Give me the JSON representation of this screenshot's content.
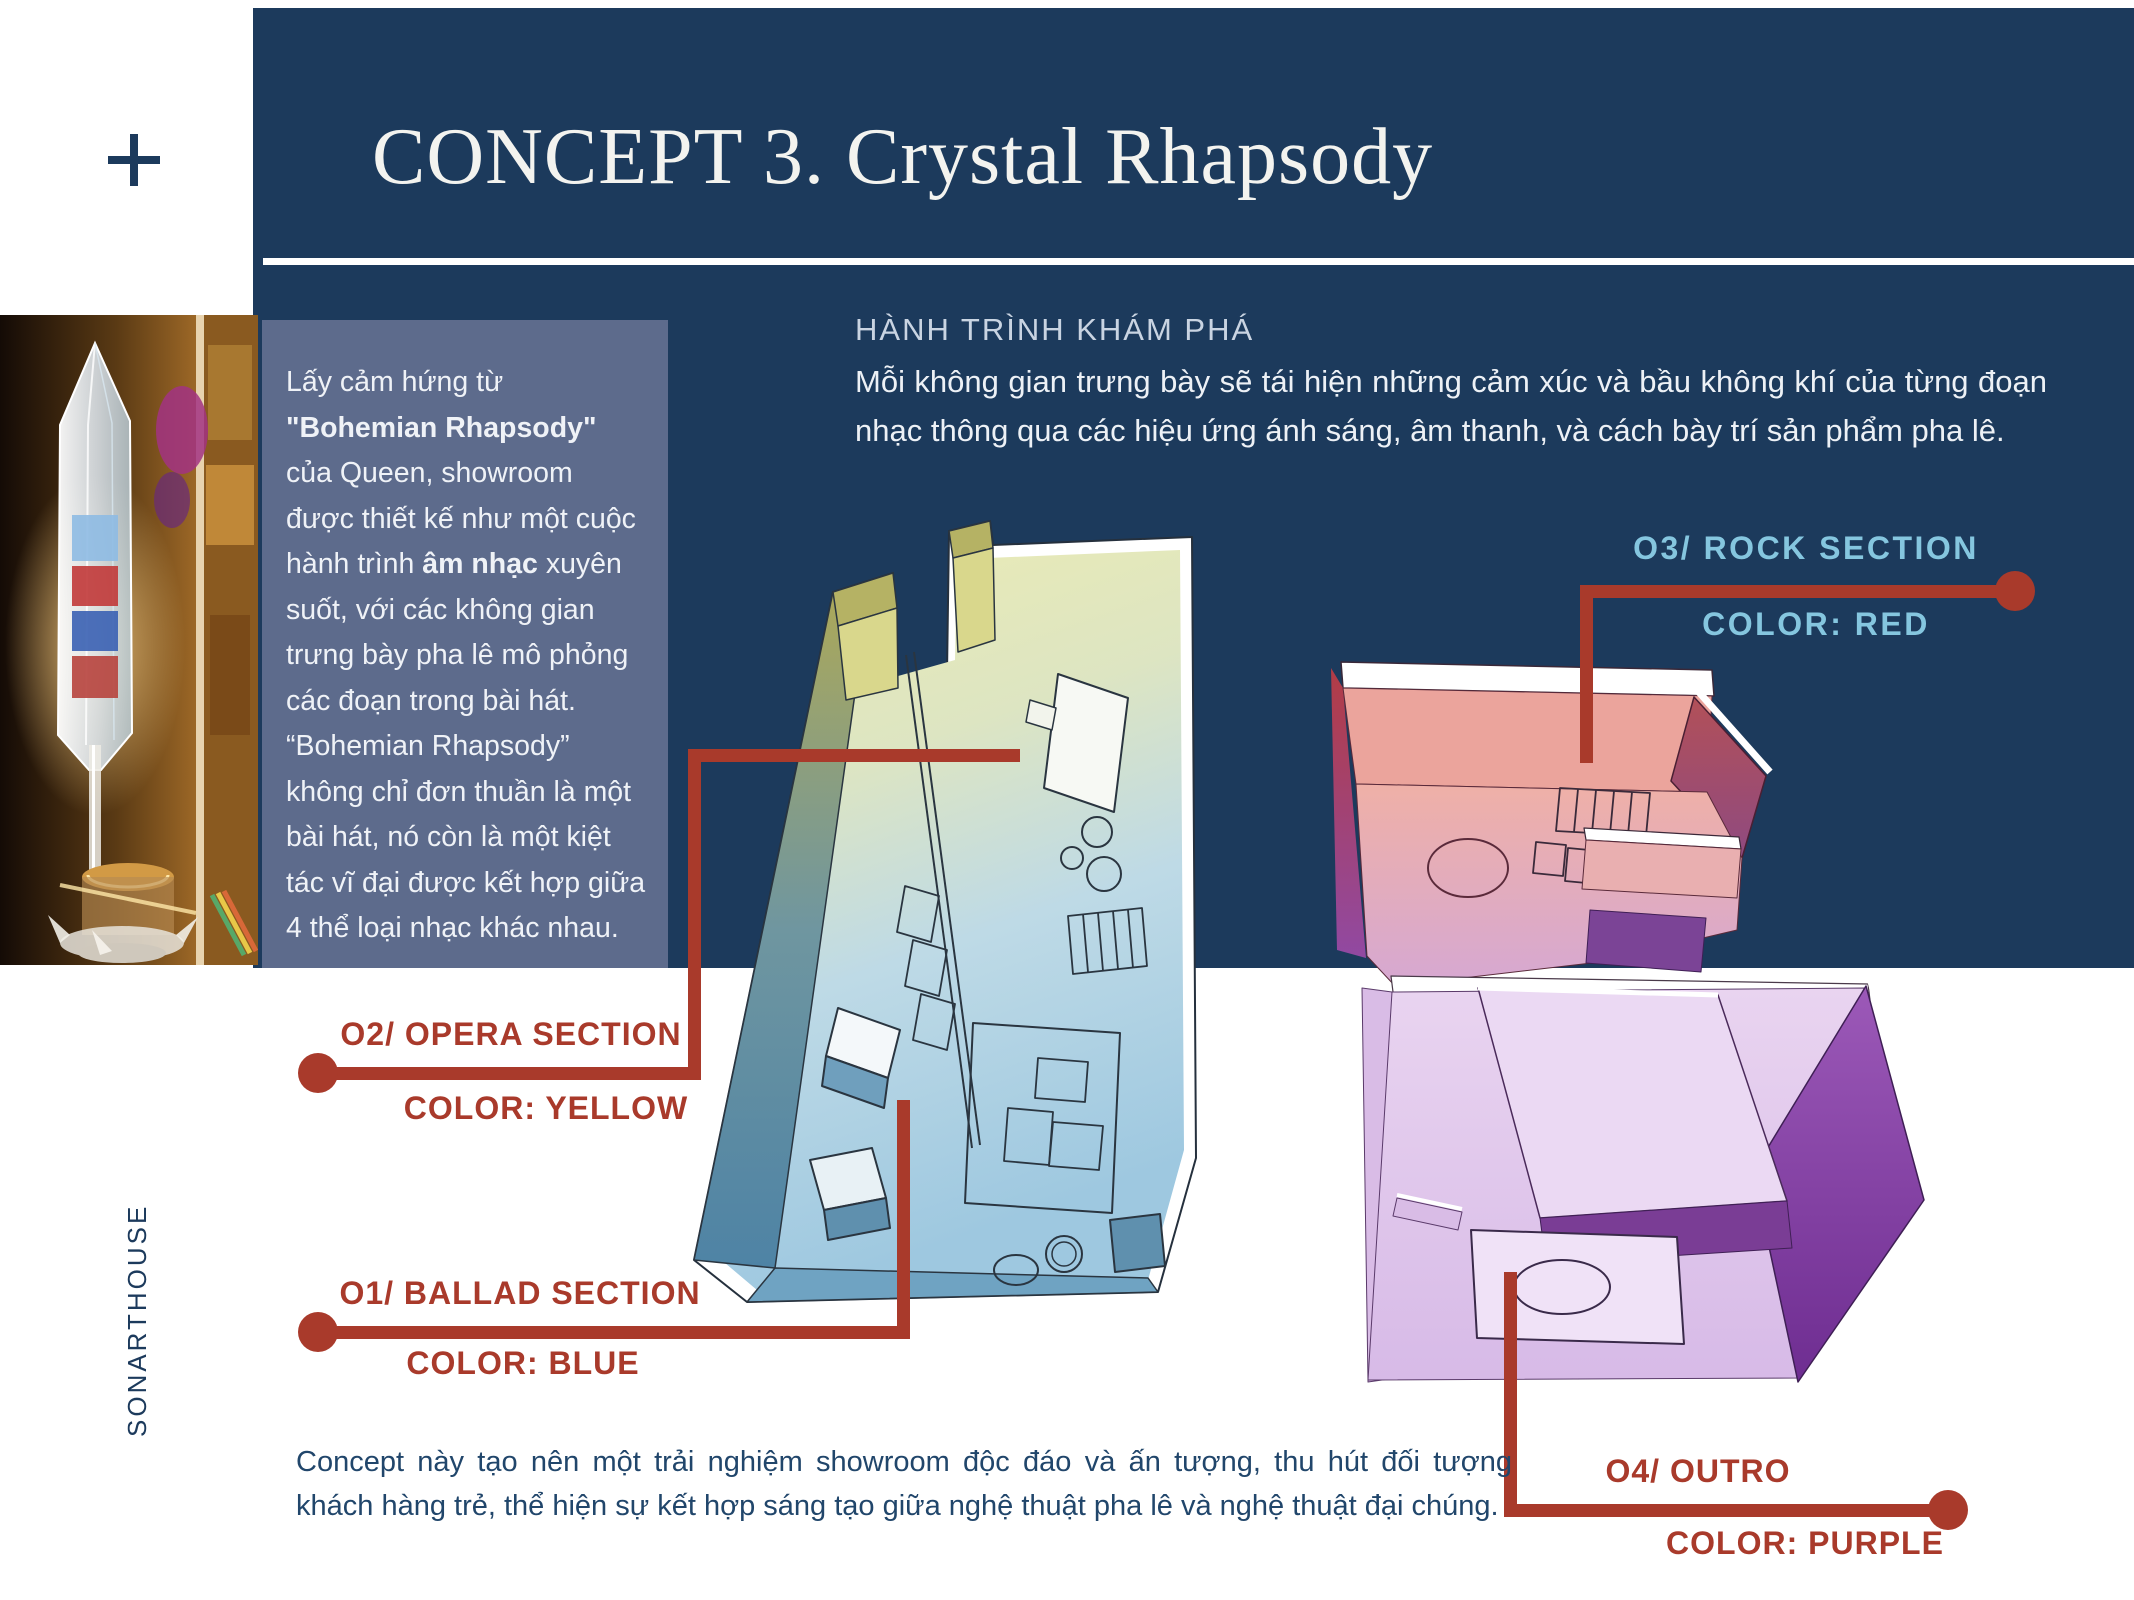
{
  "slide": {
    "title": "CONCEPT 3. Crystal Rhapsody",
    "brand_vertical": "SONARTHOUSE"
  },
  "colors": {
    "navy_bg": "#1C3A5C",
    "panel_bg": "#5D6B8C",
    "accent_red": "#A93A2B",
    "label_light_blue": "#85C6DF",
    "body_text_dark": "#21466B",
    "body_text_light": "#EFF2F7"
  },
  "intro_panel": {
    "runs": [
      {
        "text": "Lấy cảm hứng từ ",
        "bold": false
      },
      {
        "text": "\"Bohemian Rhapsody\"",
        "bold": true
      },
      {
        "text": " của Queen, showroom được thiết kế như một cuộc hành trình ",
        "bold": false
      },
      {
        "text": "âm nhạc",
        "bold": true
      },
      {
        "text": " xuyên suốt, với các không gian trưng bày pha lê mô phỏng các đoạn trong bài hát. “Bohemian Rhapsody” không chỉ đơn thuần là một bài hát, nó còn là một kiệt tác vĩ đại được kết hợp giữa 4 thể loại nhạc khác nhau.",
        "bold": false
      }
    ]
  },
  "discovery": {
    "heading": "HÀNH TRÌNH KHÁM PHÁ",
    "body": "Mỗi không gian trưng bày sẽ tái hiện những cảm xúc và bầu không khí của từng đoạn nhạc thông qua các hiệu ứng ánh sáng, âm thanh, và cách bày trí sản phẩm pha lê."
  },
  "callouts": {
    "opera": {
      "label": "O2/ OPERA SECTION",
      "color_label": "COLOR: YELLOW"
    },
    "ballad": {
      "label": "O1/ BALLAD SECTION",
      "color_label": "COLOR: BLUE"
    },
    "rock": {
      "label": "O3/ ROCK SECTION",
      "color_label": "COLOR: RED"
    },
    "outro": {
      "label": "O4/ OUTRO",
      "color_label": "COLOR: PURPLE"
    }
  },
  "footer": {
    "body": "Concept này tạo nên một trải nghiệm showroom độc đáo và ấn tượng, thu hút đối tượng khách hàng trẻ, thể hiện sự kết hợp sáng tạo giữa nghệ thuật pha lê và nghệ thuật đại chúng."
  }
}
